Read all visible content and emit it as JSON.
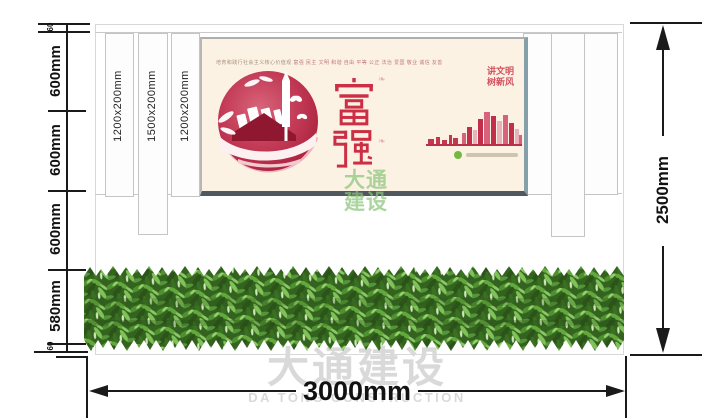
{
  "dimensions": {
    "left_segments": [
      {
        "label": "60"
      },
      {
        "label": "600mm"
      },
      {
        "label": "600mm"
      },
      {
        "label": "600mm"
      },
      {
        "label": "580mm"
      },
      {
        "label": "60"
      }
    ],
    "height_total_label": "2500mm",
    "width_total_label": "3000mm",
    "slat_labels": [
      "1200x200mm",
      "1500x200mm",
      "1200x200mm"
    ]
  },
  "poster": {
    "header_prefix": "培育和践行社会主义核心价值观",
    "header_values": "富强 民主 文明 和谐 自由 平等 公正 法治 爱国 敬业 诚信 友善",
    "main_word": "富强",
    "main_char_1": "富",
    "main_char_2": "强",
    "slogan_line_1": "讲文明",
    "slogan_line_2": "树新风",
    "accent_color": "#c9304a",
    "background_color": "#fcf2e3"
  },
  "watermarks": {
    "green_line_1": "大通",
    "green_line_2": "建设",
    "gray_cn": "大通建设",
    "gray_en": "DA TONG CONSTRUCTION"
  }
}
